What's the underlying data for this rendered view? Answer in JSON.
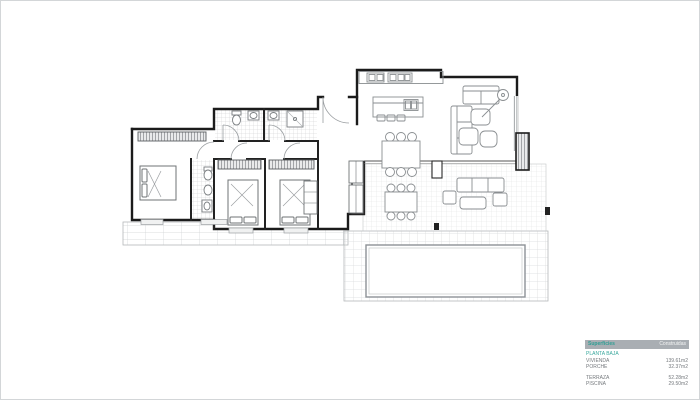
{
  "legend": {
    "header": {
      "col1": "Superficies",
      "col2": "Construidas"
    },
    "section_title": "PLANTA BAJA",
    "rows": [
      {
        "label": "VIVIENDA",
        "value": "139.61m2"
      },
      {
        "label": "PORCHE",
        "value": "32.37m2"
      },
      {
        "label": "TERRAZA",
        "value": "52.28m2"
      },
      {
        "label": "PISCINA",
        "value": "29.50m2"
      }
    ]
  },
  "colors": {
    "accent_teal": "#3aa89d",
    "legend_header_bg": "#a9aeb3",
    "legend_text": "#75797d",
    "wall": "#1b1b1b",
    "furniture_line": "#8a8a8a",
    "tile_line": "#d8dadb",
    "pool_border": "#8d9296",
    "background": "#ffffff"
  }
}
